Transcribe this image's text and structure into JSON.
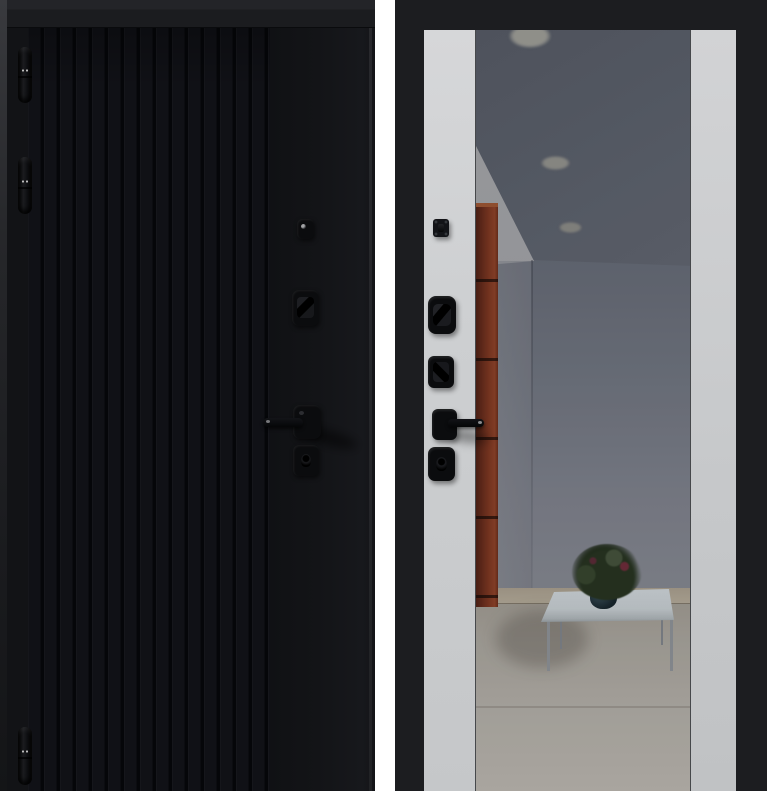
{
  "image": {
    "type": "product-photo",
    "subject": "steel entry door shown from exterior and interior sides",
    "views": [
      {
        "name": "exterior-side",
        "finish": "black with vertical fluted slats"
      },
      {
        "name": "interior-side",
        "finish": "light gray panels with full-height mirror insert"
      }
    ]
  },
  "front_view": {
    "hinge_count": 3,
    "hardware": [
      "door-viewer",
      "cylinder-lock",
      "lever-handle",
      "secondary-lock"
    ]
  },
  "back_view": {
    "side_panel_count": 2,
    "hardware": [
      "night-latch",
      "cylinder-cover",
      "deadbolt",
      "lever-handle",
      "secondary-lock"
    ]
  },
  "reflection": {
    "recessed_light_count": 3,
    "objects": [
      "gray ceiling",
      "gray walls",
      "orange-brown cabinet column",
      "white glass coffee table",
      "potted plant in dark vase",
      "light tile floor"
    ]
  },
  "colors": {
    "page_bg": "#ffffff",
    "door_black": "#121316",
    "groove_dark": "#050609",
    "slat": "#15161b",
    "top_bar": "#232428",
    "frame_black": "#1c1d20",
    "panel_light": "#d6d7d9",
    "panel_dark": "#c6c8ca",
    "hw_black": "#0b0c0e",
    "hinge_dot": "#bdbdbd",
    "ceiling": "#646973",
    "ceiling_dark": "#555a64",
    "wall": "#666b75",
    "wall_light": "#7e818b",
    "lit_wall": "#9b9c9f",
    "light_glow": "#9d9d96",
    "cabinet": "#7b351f",
    "cabinet_dark": "#4f2013",
    "cabinet_light": "#8d4126",
    "floor": "#9e998f",
    "floor_light": "#bab6ae",
    "baseboard": "#a99f8d",
    "table_top": "#c7ced1",
    "table_leg": "#8e9297",
    "plant_green": "#26331f",
    "plant_dark": "#17220f",
    "flower_red": "#6e2b38",
    "vase": "#16242a"
  }
}
